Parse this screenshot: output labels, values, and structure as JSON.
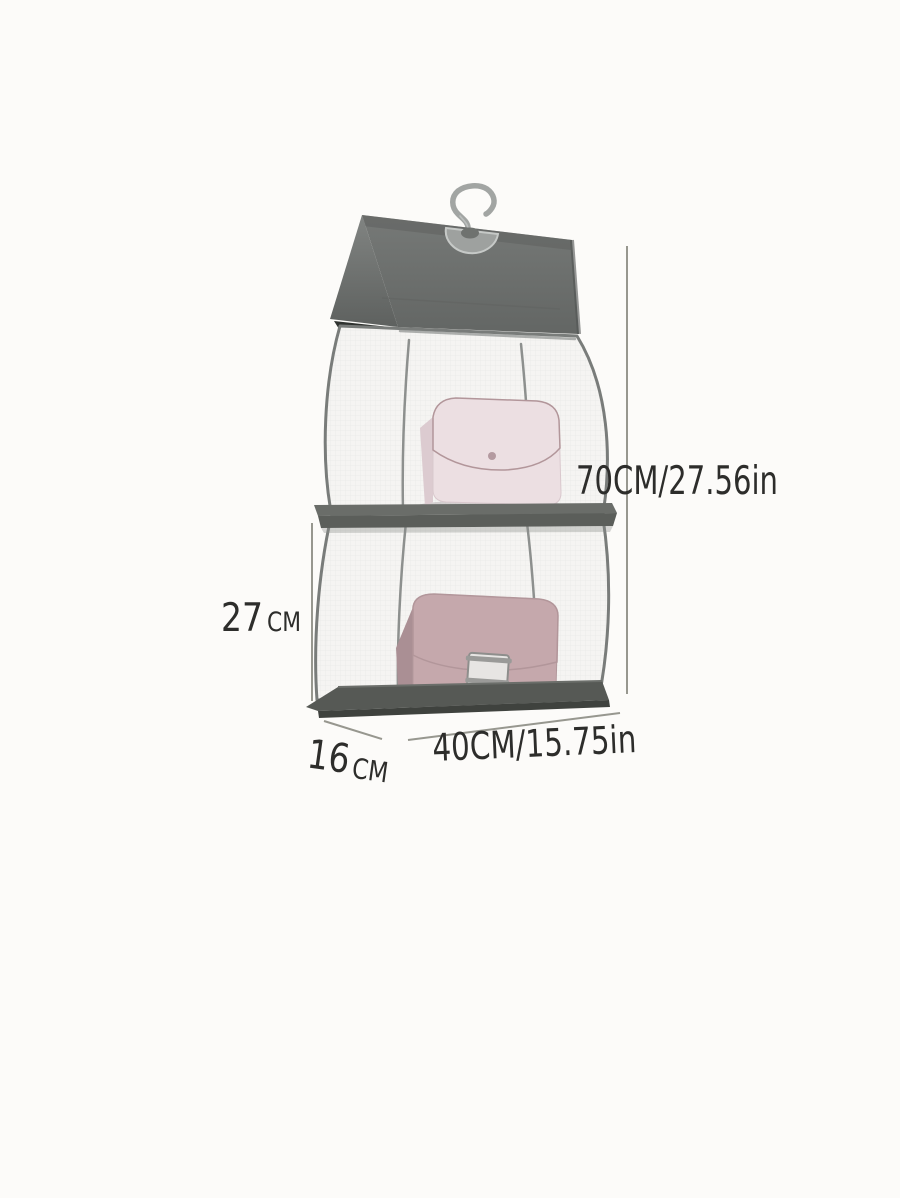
{
  "page": {
    "background": "#fcfbf9",
    "description": "Product dimension photo of a grey 2-compartment hanging handbag organizer holding two pink handbags"
  },
  "product": {
    "colors": {
      "cover": "#6d706e",
      "cover_fold": "#7a7d7b",
      "cover_shadow": "#2f322f",
      "mesh": "#f5f4f2",
      "seam": "#797c7a",
      "shelf": "#5b5e5a",
      "base": "#53565?",
      "base_top": "#565955",
      "hook": "#a2a5a3",
      "grommet": "#9ea19f",
      "bag_top": "#ecdfe2",
      "bag_top_flap": "#f0e5e8",
      "bag_bottom": "#c5a8ac",
      "bag_bottom_flap": "#ccafb3",
      "clasp": "#e7e5e3",
      "annotation_line": "#97978f",
      "annotation_text": "#2d2d2b"
    }
  },
  "annotations": {
    "height": {
      "label": "70CM/27.56in"
    },
    "compartment_height": {
      "value": "27",
      "unit": "CM"
    },
    "depth": {
      "value": "16",
      "unit": "CM"
    },
    "width": {
      "label": "40CM/15.75in"
    }
  }
}
